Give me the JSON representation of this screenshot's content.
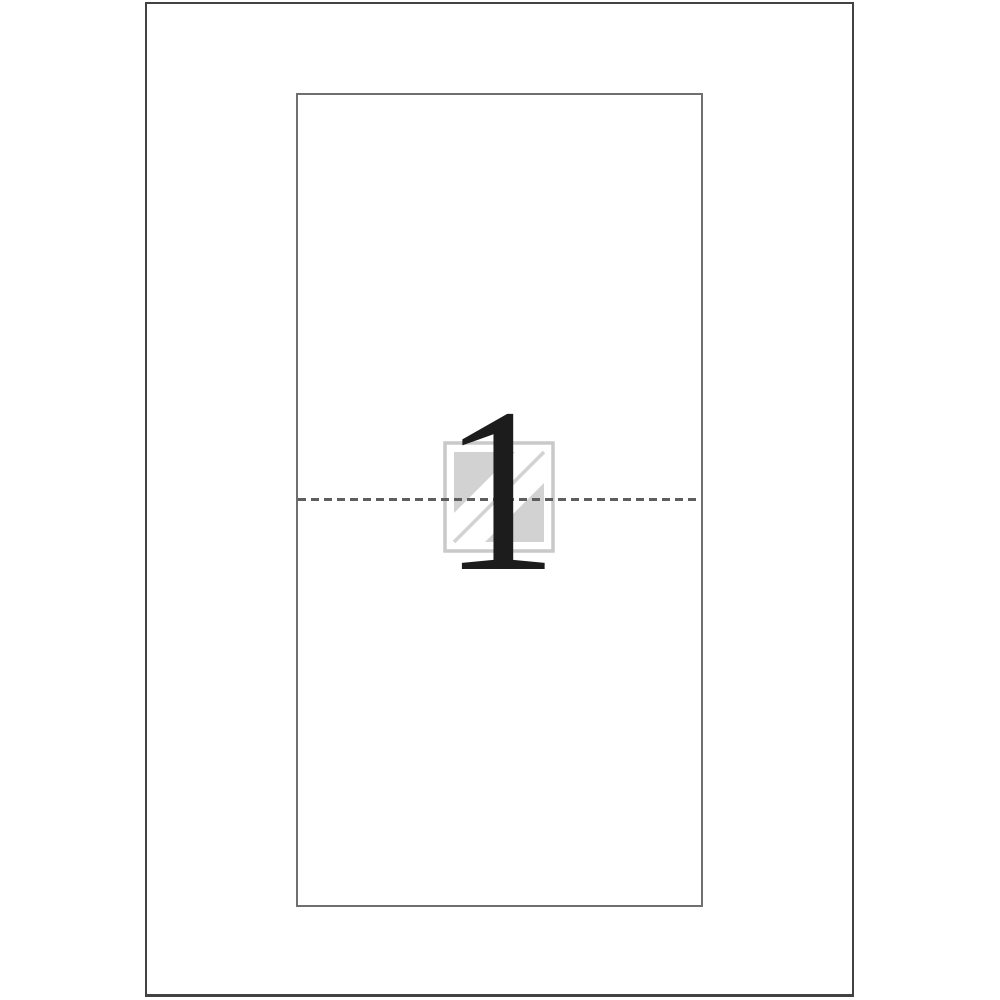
{
  "sheet": {
    "kind": "label-sheet-template-preview",
    "label_number": "1",
    "labels_visible": 1
  },
  "icons": {
    "watermark": "label-watermark-icon"
  },
  "colors": {
    "background": "#ffffff",
    "page_border": "#424242",
    "label_border": "#6f6f6f",
    "perforation_dash": "#5e5e5e",
    "watermark_border": "#c9c9c9",
    "watermark_fill": "#d2d2d2",
    "numeral": "#1c1c1c"
  }
}
